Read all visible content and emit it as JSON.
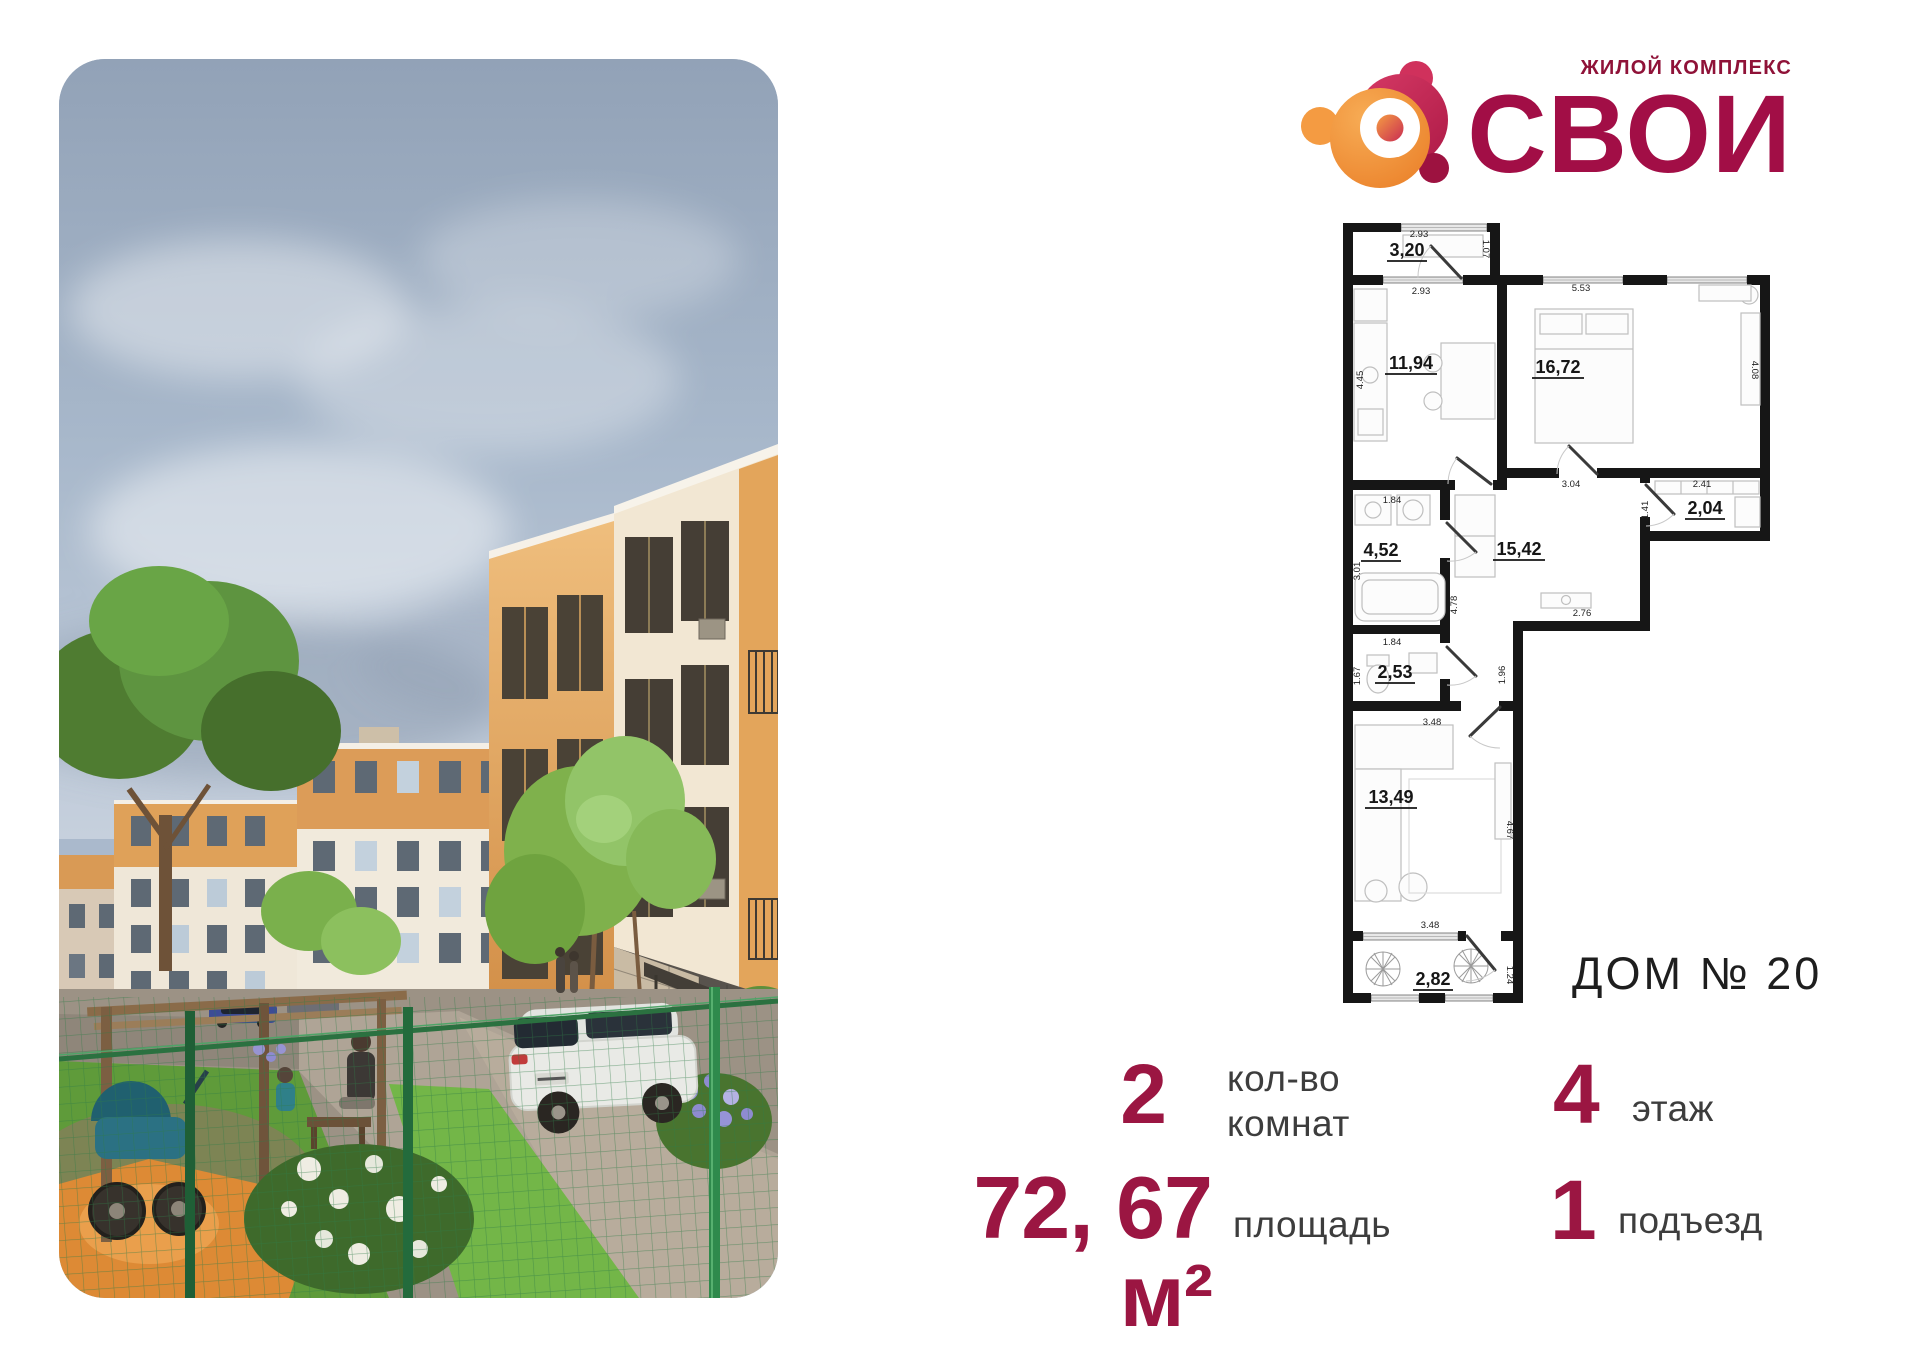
{
  "colors": {
    "accent": "#9B1642",
    "logo_crimson": "#C42052",
    "logo_orange": "#F2953F",
    "label_gray": "#3D3D3D",
    "plan_ink": "#161616"
  },
  "logo": {
    "tagline": "ЖИЛОЙ КОМПЛЕКС",
    "name": "СВОИ"
  },
  "plan": {
    "house": "ДОМ № 20",
    "balcony_top": {
      "area": "3,20",
      "dim_w": "2.93",
      "dim_h": "1.07"
    },
    "kitchen": {
      "area": "11,94",
      "dim_w": "2.93",
      "dim_h": "4.45"
    },
    "bedroom": {
      "area": "16,72",
      "dim_w": "5.53",
      "dim_h": "4.08",
      "dim_b": "3.04"
    },
    "pantry": {
      "area": "2,04",
      "dim_w": "2.41",
      "dim_h": "1.41"
    },
    "bathroom": {
      "area": "4,52",
      "dim_w": "1.84",
      "dim_h": "3.01"
    },
    "hall": {
      "area": "15,42",
      "dim_h": "4.78",
      "dim_w": "2.76",
      "dim_w2": "1.96"
    },
    "wc": {
      "area": "2,53",
      "dim_w": "1.84",
      "dim_h": "1.67"
    },
    "living": {
      "area": "13,49",
      "dim_w": "3.48",
      "dim_h": "4.67",
      "dim_b": "3.48"
    },
    "balcony_bottom": {
      "area": "2,82",
      "dim_h": "1.24"
    }
  },
  "stats": {
    "rooms": {
      "value": "2",
      "label": "кол-во комнат"
    },
    "area": {
      "value": "72, 67 м²",
      "label": "площадь"
    },
    "floor": {
      "value": "4",
      "label": "этаж"
    },
    "entrance": {
      "value": "1",
      "label": "подъезд"
    }
  }
}
